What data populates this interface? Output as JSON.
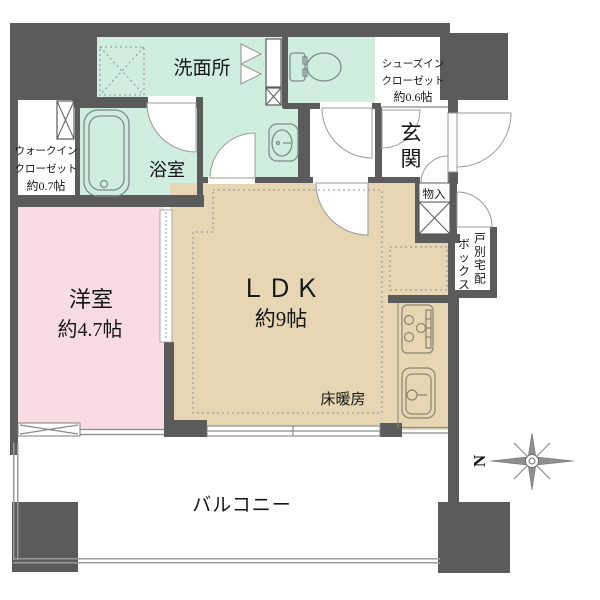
{
  "title": "マンション間取り図",
  "colors": {
    "wall": "#5b5b5b",
    "wet_area": "#cfeee0",
    "ldk_floor": "#e6d6b4",
    "bedroom_floor": "#f9dbe4",
    "background": "#ffffff"
  },
  "rooms": {
    "washroom": {
      "label": "洗面所"
    },
    "bathroom": {
      "label": "浴室"
    },
    "walk_in_closet": {
      "line1": "ウォークイン",
      "line2": "クローゼット",
      "line3": "約0.7帖"
    },
    "shoes_in_closet": {
      "line1": "シューズイン",
      "line2": "クローゼット",
      "line3": "約0.6帖"
    },
    "entrance": {
      "label": "玄関"
    },
    "storage": {
      "label": "物入"
    },
    "delivery_box": {
      "col_right": "戸別宅配",
      "col_left": "ボックス"
    },
    "western_room": {
      "label": "洋室",
      "size": "約4.7帖"
    },
    "ldk": {
      "label": "ＬＤＫ",
      "size": "約9帖"
    },
    "floor_heating": {
      "label": "床暖房"
    },
    "balcony": {
      "label": "バルコニー"
    }
  },
  "compass": {
    "north_label": "N"
  }
}
